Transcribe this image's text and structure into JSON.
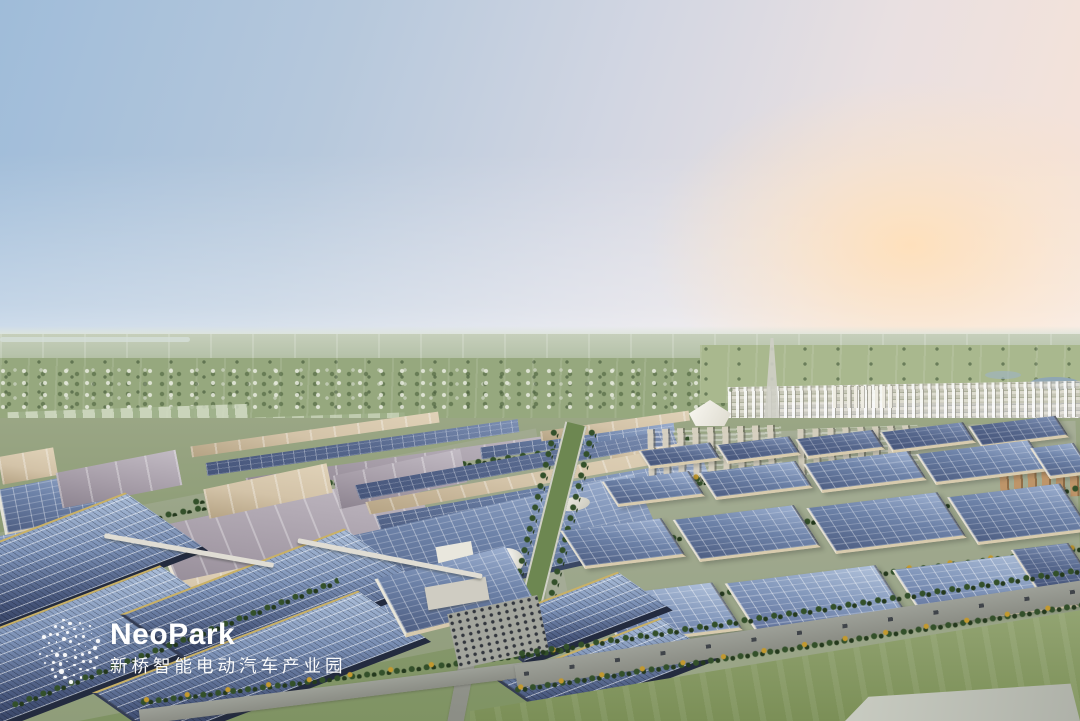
{
  "scene": {
    "setting": "Aerial architectural rendering of a solar-roofed electric-vehicle industrial park at dusk",
    "landmarks": [
      "factory halls with blue photovoltaic roofs",
      "tree-lined boulevards and parking lots",
      "white tent-shaped landmark hall",
      "round white exhibition dome",
      "residential tower district on the horizon",
      "farmland plain fading into haze"
    ]
  },
  "logo": {
    "name": "NeoPark",
    "subtitle": "新桥智能电动汽车产业园"
  },
  "colors": {
    "sky-blue": "#9fbcd9",
    "sky-pink": "#f3e2da",
    "sun-peach": "#fde3c4",
    "haze": "#dde4da",
    "far-plain": "#b7c3ab",
    "field-green": "#96a87e",
    "park-green": "#7f9363",
    "tree-green": "#33502a",
    "tree-gold": "#c2992f",
    "solar-blue": "#6d82a8",
    "solar-dark": "#46557a",
    "roof-beige": "#d3c3a8",
    "roof-mauve": "#a49ba6",
    "wall-beige": "#d6c9ad",
    "road-gray": "#8b8d85",
    "paved-gray": "#b5b7ae",
    "city-white": "#e3e1d8",
    "water-blue": "#8fa6b4",
    "logo-white": "#ffffff"
  }
}
